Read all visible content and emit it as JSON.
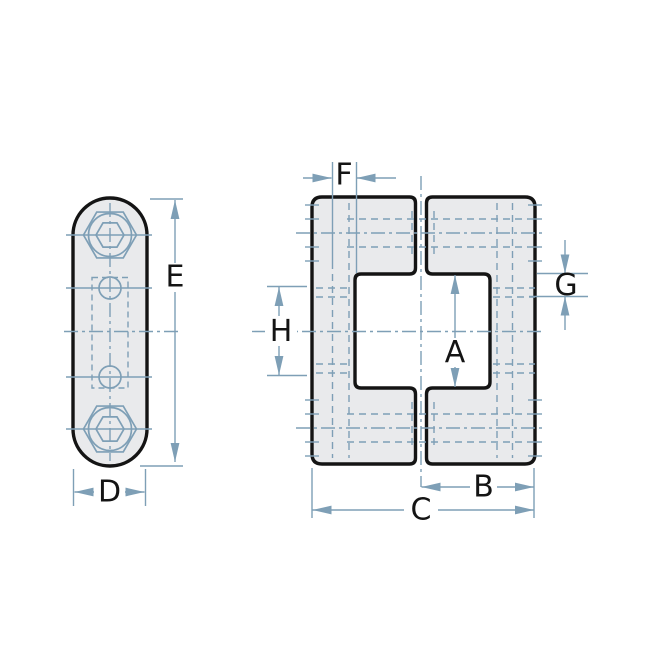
{
  "colors": {
    "background": "#ffffff",
    "part-fill": "#e9eaec",
    "outline": "#141414",
    "line-blue": "#7e9fb6"
  },
  "labels": {
    "A": "A",
    "B": "B",
    "C": "C",
    "D": "D",
    "E": "E",
    "F": "F",
    "G": "G",
    "H": "H"
  }
}
